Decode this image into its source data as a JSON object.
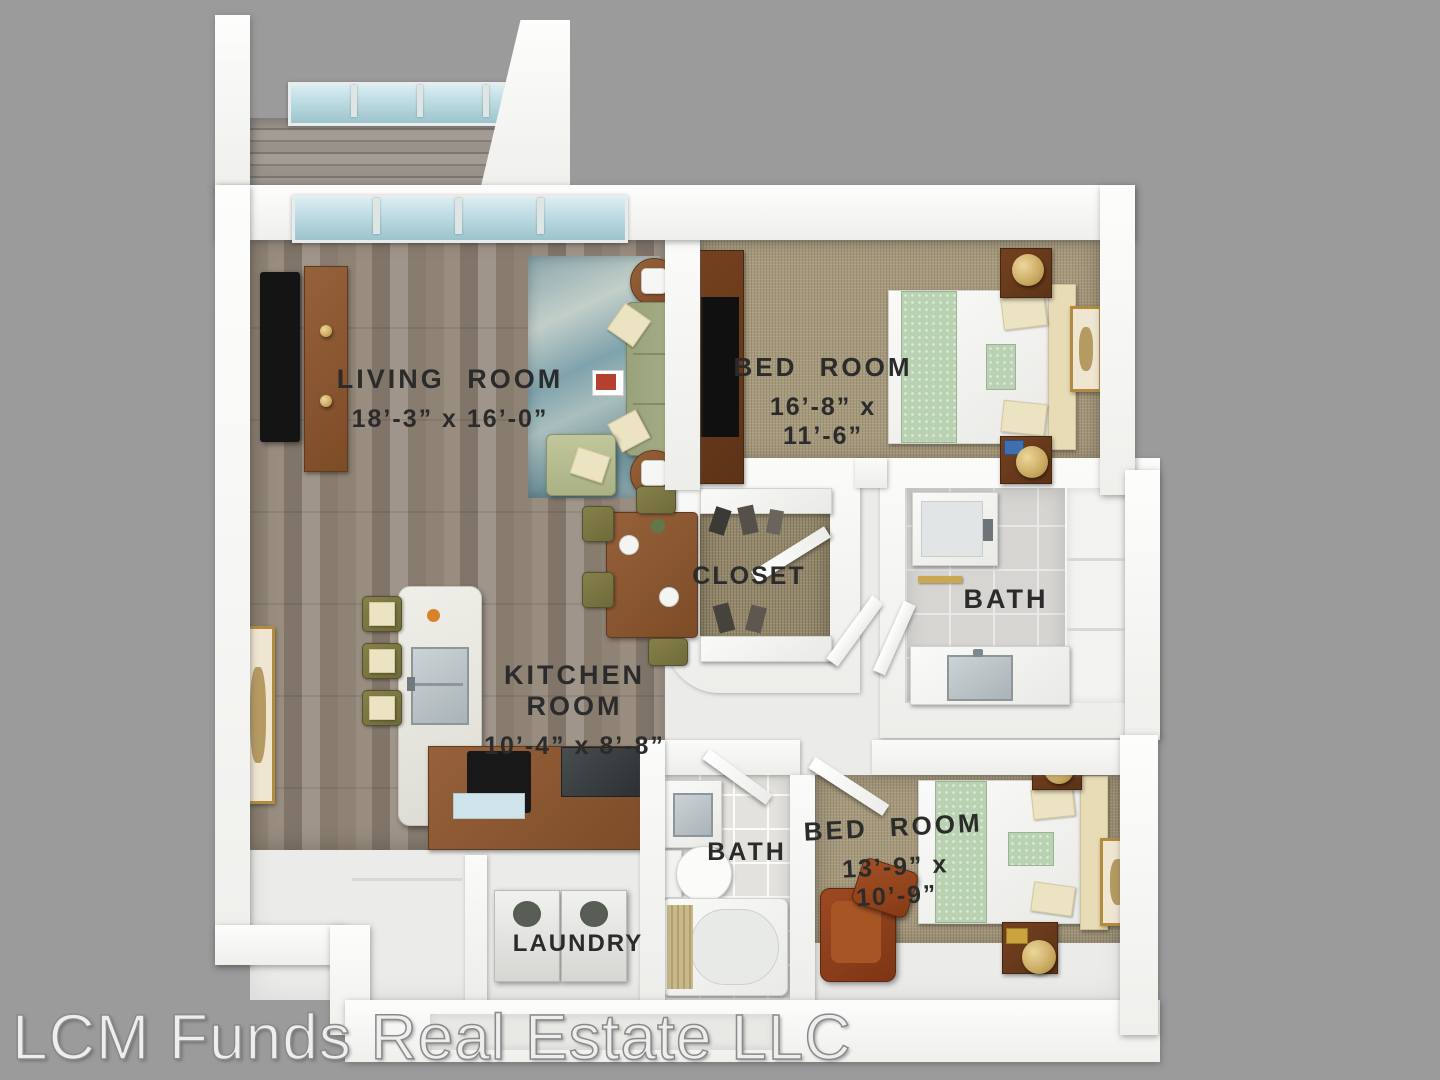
{
  "watermark": {
    "text": "LCM Funds Real Estate LLC"
  },
  "rooms": {
    "living": {
      "label": "LIVING ROOM",
      "dims": "18’-3” x 16’-0”"
    },
    "bedroom1": {
      "label": "BED ROOM",
      "dims": "16’-8” x 11’-6”"
    },
    "kitchen": {
      "label": "KITCHEN ROOM",
      "dims": "10’-4” x 8’-8”"
    },
    "bedroom2": {
      "label": "BED ROOM",
      "dims": "13’-9” x 10’-9”"
    },
    "closet": {
      "label": "CLOSET"
    },
    "bath1": {
      "label": "BATH"
    },
    "bath2": {
      "label": "BATH"
    },
    "laundry": {
      "label": "LAUNDRY"
    }
  },
  "colors": {
    "background": "#9b9b9b",
    "wall": "#f6f6f4",
    "wood_floor": "#8f8375",
    "carpet": "#a79a7d",
    "closet_carpet": "#95896c",
    "bath_tile": "#d6d5d2",
    "glass": "#aed3da",
    "sofa": "#a3ab83",
    "wood_furniture": "#8a5a33",
    "leather_chair": "#8f3f1c",
    "rug": "#7fa2ac",
    "label_text": "#2b2b2b"
  }
}
